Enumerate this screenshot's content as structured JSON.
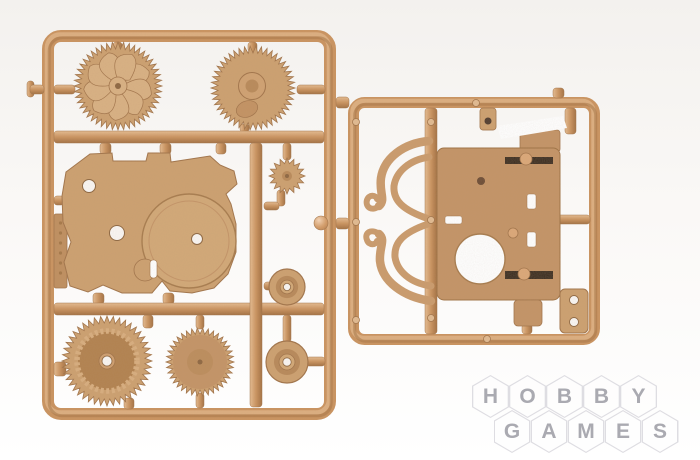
{
  "image": {
    "subject": "plastic model kit sprue frames with gears and housing parts, tan molded plastic, product photo on white background",
    "width": 700,
    "height": 460
  },
  "colors": {
    "background_top": "#f3f1ee",
    "background_bottom": "#ffffff",
    "runner_light": "#e6bd93",
    "runner_mid": "#cb9460",
    "runner_dark": "#a47142",
    "part": "#cda171",
    "part_light": "#dcb288",
    "part_lighter": "#d9b184",
    "part_dark": "#a2744a",
    "bowl": "#b2824f",
    "plain_fill": "#c49467",
    "contact_dark": "#35261c",
    "pin": "#dca87a",
    "hole_fill": "#faf7f4",
    "outline": "#8d6640",
    "white": "#ffffff"
  },
  "sprue": {
    "left_frame": {
      "ring": {
        "x": 48,
        "y": 36,
        "w": 282,
        "h": 378,
        "rx": 13,
        "sw": 12
      },
      "bars": [
        {
          "name": "crossbar-top",
          "x": 54,
          "y": 131,
          "w": 270,
          "h": 12,
          "o": "h"
        },
        {
          "name": "crossbar-bottom",
          "x": 54,
          "y": 303,
          "w": 270,
          "h": 12,
          "o": "h"
        },
        {
          "name": "vertical-runner",
          "x": 250,
          "y": 143,
          "w": 12,
          "h": 264,
          "o": "v"
        }
      ],
      "stubs": [
        {
          "x": 27,
          "y": 81,
          "w": 7,
          "h": 16,
          "o": "v"
        },
        {
          "x": 30,
          "y": 85,
          "w": 14,
          "h": 9,
          "o": "h"
        },
        {
          "x": 54,
          "y": 85,
          "w": 21,
          "h": 9,
          "o": "h"
        },
        {
          "x": 113,
          "y": 42,
          "w": 9,
          "h": 10,
          "o": "v"
        },
        {
          "x": 248,
          "y": 42,
          "w": 9,
          "h": 10,
          "o": "v"
        },
        {
          "x": 297,
          "y": 85,
          "w": 28,
          "h": 9,
          "o": "h"
        },
        {
          "x": 240,
          "y": 124,
          "w": 9,
          "h": 8,
          "o": "v"
        },
        {
          "x": 283,
          "y": 143,
          "w": 8,
          "h": 17,
          "o": "v"
        },
        {
          "x": 277,
          "y": 190,
          "w": 8,
          "h": 16,
          "o": "v"
        },
        {
          "x": 264,
          "y": 202,
          "w": 15,
          "h": 8,
          "o": "h"
        },
        {
          "x": 264,
          "y": 282,
          "w": 24,
          "h": 8,
          "o": "h"
        },
        {
          "x": 283,
          "y": 315,
          "w": 8,
          "h": 27,
          "o": "v"
        },
        {
          "x": 306,
          "y": 357,
          "w": 19,
          "h": 9,
          "o": "h"
        },
        {
          "x": 143,
          "y": 315,
          "w": 10,
          "h": 13,
          "o": "v"
        },
        {
          "x": 124,
          "y": 398,
          "w": 10,
          "h": 11,
          "o": "v"
        },
        {
          "x": 196,
          "y": 315,
          "w": 8,
          "h": 14,
          "o": "v"
        },
        {
          "x": 196,
          "y": 393,
          "w": 8,
          "h": 15,
          "o": "v"
        },
        {
          "x": 100,
          "y": 143,
          "w": 11,
          "h": 11,
          "o": "v"
        },
        {
          "x": 160,
          "y": 143,
          "w": 11,
          "h": 11,
          "o": "v"
        },
        {
          "x": 216,
          "y": 143,
          "w": 10,
          "h": 11,
          "o": "v"
        },
        {
          "x": 93,
          "y": 293,
          "w": 11,
          "h": 11,
          "o": "v"
        },
        {
          "x": 163,
          "y": 293,
          "w": 11,
          "h": 11,
          "o": "v"
        },
        {
          "x": 54,
          "y": 196,
          "w": 10,
          "h": 9,
          "o": "h"
        },
        {
          "x": 54,
          "y": 362,
          "w": 12,
          "h": 14,
          "o": "v"
        }
      ],
      "text_tab": {
        "x": 54,
        "y": 214,
        "w": 13,
        "h": 74,
        "ticks": 6
      }
    },
    "right_frame": {
      "ring": {
        "x": 353.5,
        "y": 102.5,
        "w": 241,
        "h": 237,
        "rx": 11,
        "sw": 11
      },
      "bars": [
        {
          "name": "vertical-runner-right",
          "x": 425,
          "y": 108,
          "w": 12,
          "h": 226,
          "o": "v"
        }
      ],
      "stubs": [
        {
          "x": 336,
          "y": 97,
          "w": 13,
          "h": 11,
          "o": "h"
        },
        {
          "x": 336,
          "y": 218,
          "w": 13,
          "h": 11,
          "o": "h"
        },
        {
          "x": 557,
          "y": 215,
          "w": 33,
          "h": 9,
          "o": "h"
        },
        {
          "x": 565,
          "y": 108,
          "w": 11,
          "h": 26,
          "o": "v"
        },
        {
          "x": 553,
          "y": 88,
          "w": 11,
          "h": 10,
          "o": "v"
        },
        {
          "x": 480,
          "y": 108,
          "w": 16,
          "h": 22,
          "o": "v"
        },
        {
          "x": 522,
          "y": 324,
          "w": 10,
          "h": 10,
          "o": "v"
        }
      ],
      "ejector_holes": [
        {
          "cx": 356,
          "cy": 122
        },
        {
          "cx": 356,
          "cy": 222
        },
        {
          "cx": 356,
          "cy": 320
        },
        {
          "cx": 431,
          "cy": 122
        },
        {
          "cx": 431,
          "cy": 220
        },
        {
          "cx": 431,
          "cy": 318
        },
        {
          "cx": 476,
          "cy": 103
        },
        {
          "cx": 487,
          "cy": 339
        }
      ]
    },
    "gears": [
      {
        "name": "fan-turbine-gear",
        "cx": 118,
        "cy": 86,
        "rOuter": 44,
        "rRoot": 37,
        "teeth": 48,
        "style": "fan",
        "blades": 9
      },
      {
        "name": "hub-gear",
        "cx": 253,
        "cy": 88,
        "rOuter": 42,
        "rRoot": 35,
        "teeth": 46,
        "style": "hub"
      },
      {
        "name": "small-pinion-gear",
        "cx": 287,
        "cy": 176,
        "rOuter": 18,
        "rRoot": 12.5,
        "teeth": 16,
        "style": "small"
      },
      {
        "name": "double-ring-gear",
        "cx": 107,
        "cy": 361,
        "rOuter": 45,
        "rRoot": 38,
        "teeth": 44,
        "style": "double"
      },
      {
        "name": "plain-spur-gear",
        "cx": 200,
        "cy": 362,
        "rOuter": 34,
        "rRoot": 28,
        "teeth": 38,
        "style": "plain"
      }
    ],
    "pulleys": [
      {
        "name": "pulley-small",
        "cx": 287,
        "cy": 287,
        "r": 18
      },
      {
        "name": "pulley-large",
        "cx": 287,
        "cy": 362,
        "r": 21
      }
    ],
    "plate": {
      "name": "main-body-plate",
      "d": "M 66,172 L 90,154 L 112,153 L 113,161 L 146,161 L 148,153 L 170,153 L 171,162 L 210,156 L 220,165 L 234,171 L 237,184 L 226,194 L 231,204 L 236,224 L 236,252 L 228,274 L 214,288 L 192,293 L 170,291 L 162,281 L 152,293 L 122,293 L 103,285 L 88,292 L 70,286 L 64,262 L 71,242 L 63,222 L 62,196 Z",
      "holes": [
        {
          "cx": 89,
          "cy": 186,
          "r": 6.5
        },
        {
          "cx": 117,
          "cy": 233,
          "r": 7.5
        }
      ],
      "boss": {
        "cx": 189,
        "cy": 241,
        "r": 47,
        "hole": {
          "cx": 197,
          "cy": 239,
          "r": 5.5
        }
      },
      "bump": {
        "cx": 145,
        "cy": 270,
        "r": 11
      },
      "notch": {
        "x": 150,
        "y": 260,
        "w": 7,
        "h": 18
      }
    },
    "housing": {
      "name": "gearbox-housing",
      "x": 437,
      "y": 148,
      "w": 123,
      "h": 152,
      "rx": 7,
      "top_tab": {
        "x": 520,
        "y": 130,
        "w": 40,
        "h": 22
      },
      "white_band": [
        [
          497,
          126
        ],
        [
          563,
          116
        ],
        [
          567,
          128
        ],
        [
          501,
          139
        ]
      ],
      "small_tab": {
        "x": 480,
        "y": 108,
        "w": 16,
        "h": 22
      },
      "dark_dot": {
        "cx": 488,
        "cy": 121,
        "r": 3.5
      },
      "contacts": [
        {
          "x": 505,
          "y": 157,
          "w": 48,
          "h": 7,
          "pin": {
            "cx": 526,
            "cy": 159,
            "r": 6
          }
        },
        {
          "x": 505,
          "y": 271,
          "w": 48,
          "h": 8,
          "pin": {
            "cx": 524,
            "cy": 274,
            "r": 6
          }
        }
      ],
      "slots": [
        {
          "x": 527,
          "y": 194,
          "w": 9,
          "h": 15
        },
        {
          "x": 527,
          "y": 232,
          "w": 9,
          "h": 15
        },
        {
          "x": 445,
          "y": 216,
          "w": 17,
          "h": 8
        }
      ],
      "big_hole": {
        "cx": 480,
        "cy": 259,
        "r": 25
      },
      "dark_hole": {
        "cx": 481,
        "cy": 181,
        "r": 4
      },
      "pin_dot": {
        "cx": 513,
        "cy": 233,
        "r": 5
      },
      "bottom_tab": {
        "x": 514,
        "y": 300,
        "w": 28,
        "h": 26
      }
    },
    "bracket": {
      "name": "side-bracket",
      "x": 560,
      "y": 289,
      "w": 28,
      "h": 44,
      "rx": 5,
      "holes": [
        {
          "cx": 574,
          "cy": 300,
          "r": 4.5
        },
        {
          "cx": 574,
          "cy": 322,
          "r": 4.5
        }
      ]
    },
    "hooks": [
      {
        "name": "s-hook-upper",
        "paths": [
          {
            "d": "M 429,141 C 404,143 384,158 381,178 C 379,193 386,200 379,206",
            "w": 8.5
          },
          {
            "d": "M 379,206 C 372,212 365,207 367,200 C 369,194 376,195 377,199",
            "w": 6
          },
          {
            "d": "M 429,157 C 409,160 396,172 394,186 C 393,200 402,210 429,219",
            "w": 7
          }
        ]
      },
      {
        "name": "s-hook-lower",
        "paths": [
          {
            "d": "M 431,301 C 403,297 382,281 380,261 C 379,247 386,240 379,234",
            "w": 8.5
          },
          {
            "d": "M 379,234 C 371,228 364,233 367,240 C 369,246 376,245 377,241",
            "w": 6
          },
          {
            "d": "M 431,286 C 410,283 397,271 395,257 C 394,243 402,233 428,224",
            "w": 7
          }
        ]
      }
    ],
    "ball": {
      "name": "resin-ball",
      "cx": 321,
      "cy": 223,
      "r": 7
    }
  },
  "watermark": {
    "hex_w": 37,
    "hex_h": 43,
    "dx": 37,
    "letter_color": "#a6a6ad",
    "hex_border": "#dddce1",
    "hex_fill": "#fefefe",
    "opacity": 0.95,
    "rows": [
      {
        "text": "HOBBY",
        "x": 472,
        "y": 375
      },
      {
        "text": "GAMES",
        "x": 493.5,
        "y": 410
      }
    ]
  }
}
